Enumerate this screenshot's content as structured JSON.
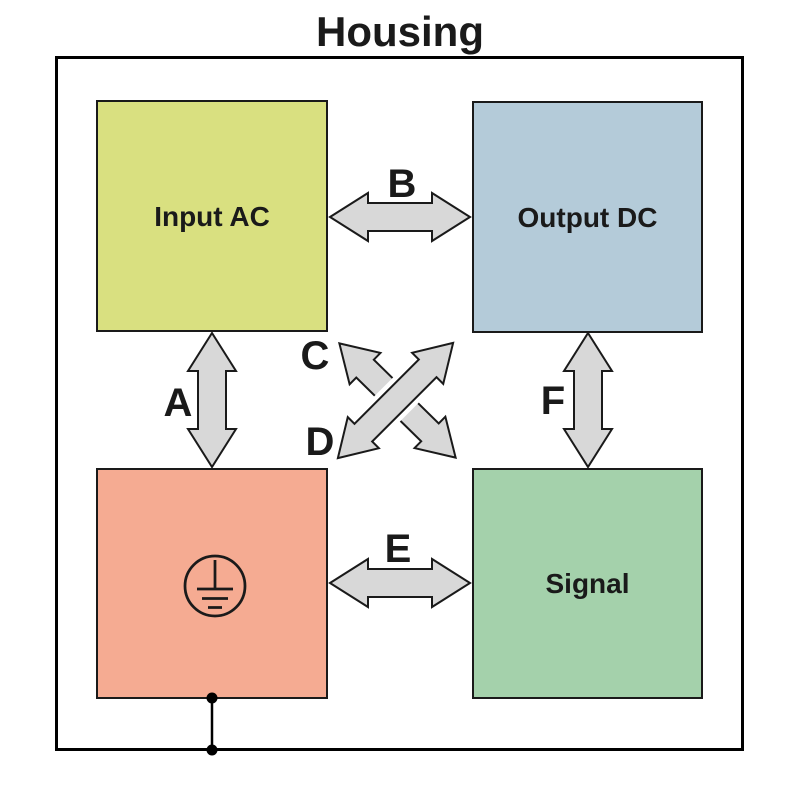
{
  "title": "Housing",
  "nodes": {
    "input_ac": {
      "label": "Input AC",
      "color": "#d9e080"
    },
    "output_dc": {
      "label": "Output DC",
      "color": "#b4cbd9"
    },
    "ground": {
      "label": "",
      "icon": "protective-earth-icon",
      "color": "#f5ab92"
    },
    "signal": {
      "label": "Signal",
      "color": "#a4d1ab"
    }
  },
  "arrows": {
    "a": {
      "label": "A",
      "type": "double-headed",
      "orientation": "vertical",
      "from": "Input AC",
      "to": "Ground block"
    },
    "b": {
      "label": "B",
      "type": "double-headed",
      "orientation": "horizontal",
      "from": "Input AC",
      "to": "Output DC"
    },
    "c": {
      "label": "C",
      "type": "double-headed",
      "orientation": "diagonal",
      "from": "Input AC",
      "to": "Signal"
    },
    "d": {
      "label": "D",
      "type": "double-headed",
      "orientation": "diagonal",
      "from": "Ground block",
      "to": "Output DC"
    },
    "e": {
      "label": "E",
      "type": "double-headed",
      "orientation": "horizontal",
      "from": "Ground block",
      "to": "Signal"
    },
    "f": {
      "label": "F",
      "type": "double-headed",
      "orientation": "vertical",
      "from": "Output DC",
      "to": "Signal"
    }
  },
  "colors": {
    "arrow_fill": "#d8d8d8",
    "outline": "#1a1a1a",
    "housing_border": "#000000",
    "background": "#ffffff"
  }
}
